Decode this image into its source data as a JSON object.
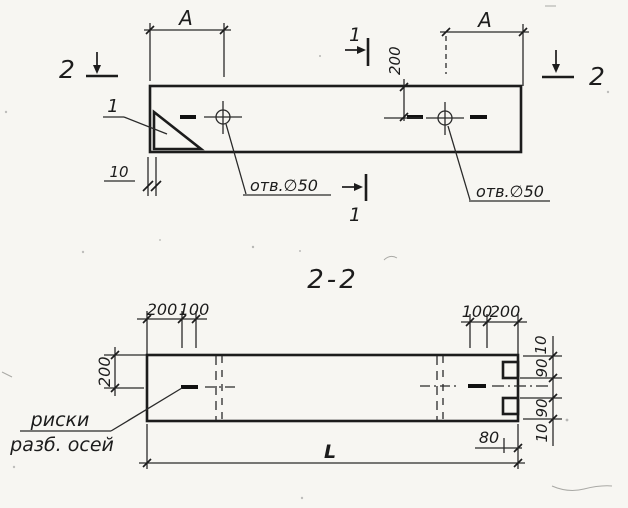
{
  "drawing": {
    "section_title": "2-2",
    "plan": {
      "dim_a_left": "A",
      "dim_a_right": "A",
      "dim_200": "200",
      "dim_10": "10",
      "hole_left_label": "отв.∅50",
      "hole_right_label": "отв.∅50",
      "callout_1": "1",
      "section_mark_1_top": "1",
      "section_mark_1_bottom": "1",
      "section_mark_2_left": "2",
      "section_mark_2_right": "2"
    },
    "section": {
      "dims_top_left": [
        "200",
        "100"
      ],
      "dims_top_right": [
        "100",
        "200"
      ],
      "dim_left_height": "200",
      "dims_right": [
        "10",
        "90",
        "90",
        "10"
      ],
      "dim_80": "80",
      "dim_length": "L",
      "axes_note_line1": "риски",
      "axes_note_line2": "разб. осей"
    }
  }
}
